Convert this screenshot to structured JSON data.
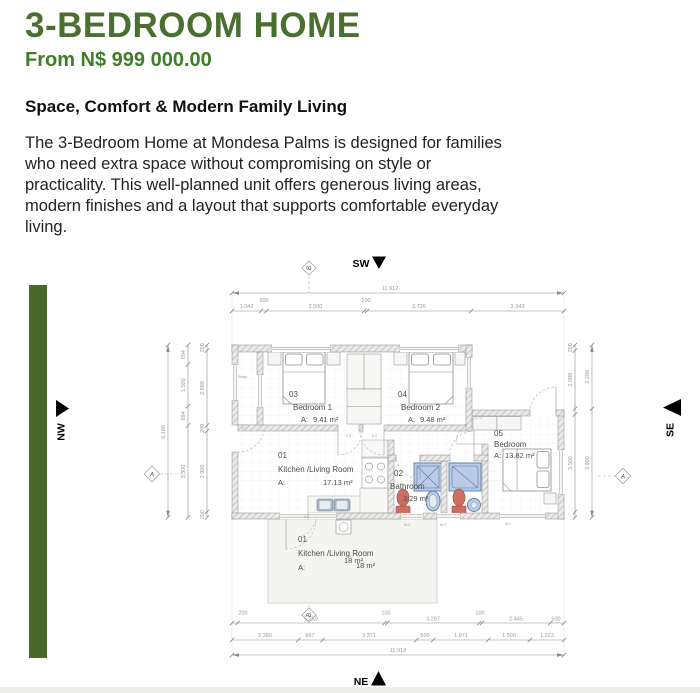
{
  "header": {
    "title": "3-BEDROOM HOME",
    "price": "From N$ 999 000.00"
  },
  "description": {
    "heading": "Space, Comfort & Modern Family Living",
    "body_lines": [
      "The 3-Bedroom Home at Mondesa Palms is designed for families",
      "who need extra space without compromising on style or",
      "practicality. This well-planned unit offers generous living areas,",
      "modern finishes and a layout that supports comfortable everyday",
      "living."
    ]
  },
  "accent": {
    "green": "#4a6929",
    "title_green": "#4a7030",
    "price_green": "#3f7d28"
  },
  "floor_plan": {
    "compass": {
      "top": "SW",
      "bottom": "NE",
      "left": "NW",
      "right": "SE"
    },
    "markers": {
      "top": "B",
      "bottom": "B",
      "left": "A",
      "right": "A"
    },
    "rooms": {
      "living": {
        "number": "01",
        "name": "Kitchen /Living Room",
        "area_prefix": "A:",
        "area": "17.13 m²"
      },
      "bathroom": {
        "number": "02",
        "name": "Bathroom",
        "area": "3.29 m²"
      },
      "bedroom1": {
        "number": "03",
        "name": "Bedroom 1",
        "area_prefix": "A:",
        "area": "9.41 m²"
      },
      "bedroom2": {
        "number": "04",
        "name": "Bedroom 2",
        "area_prefix": "A:",
        "area": "9.48 m²"
      },
      "bedroom3": {
        "number": "05",
        "name": "Bedroom",
        "area_prefix": "A:",
        "area": "13.82 m²"
      },
      "patio": {
        "number": "01",
        "name": "Kitchen /Living Room",
        "area_prefix": "A:",
        "area": "18 m²",
        "area_shadow": "18 m²"
      }
    },
    "small_labels": {
      "stoep": "Stoep",
      "door_left": "0.1",
      "door_bed1": "0.2",
      "door_bed2": "0.2",
      "door_patio": "0.1",
      "w2a": "W.2",
      "w2b": "W.2",
      "w1": "W.1"
    },
    "dims": {
      "top_total": "11.912",
      "top_wall_left": "200",
      "top_wall_mid": "100",
      "top_seg": [
        "1.042",
        "3.500",
        "3.726",
        "3.343"
      ],
      "left_total": "6.188",
      "left_mid": [
        "694",
        "1.500",
        "694",
        "3.300"
      ],
      "left_inner": [
        "200",
        "2.688",
        "200",
        "2.900",
        "200"
      ],
      "right_inner": [
        "200",
        "2.088",
        "3.500"
      ],
      "right_outer": [
        "2.288",
        "3.900"
      ],
      "bottom_r1": [
        "200",
        "5.269",
        "100",
        "3.297",
        "100",
        "2.445",
        "500"
      ],
      "bottom_r2": [
        "2.380",
        "867",
        "3.371",
        "600",
        "1.971",
        "1.500",
        "1.223"
      ],
      "bottom_total": "11.912"
    }
  }
}
